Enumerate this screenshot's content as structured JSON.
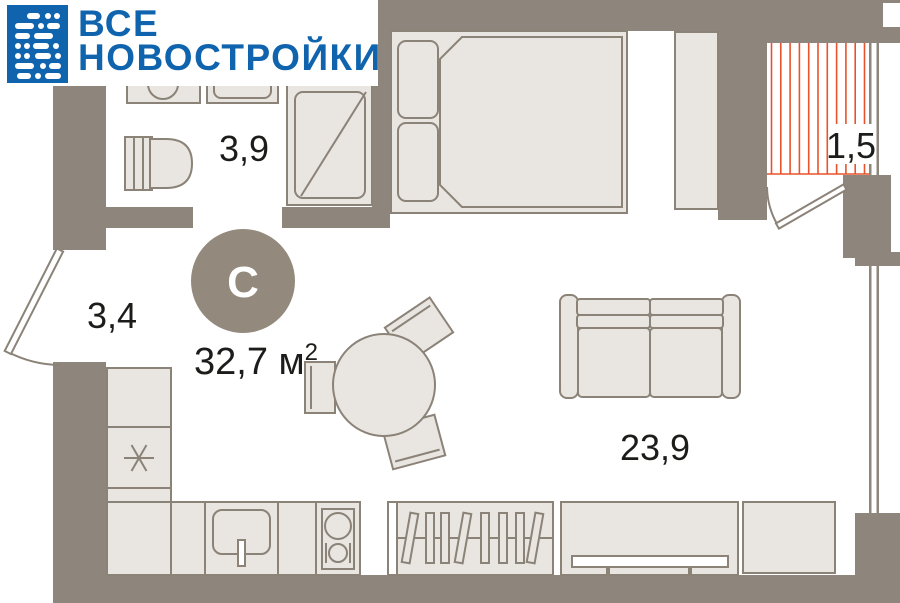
{
  "brand": {
    "line1": "ВСЕ",
    "line2": "НОВОСТРОЙКИ",
    "color": "#1064ad"
  },
  "plan": {
    "badge": "С",
    "total_area": "32,7 м",
    "total_area_superscript": "2",
    "rooms": [
      {
        "id": "bathroom",
        "area": "3,9"
      },
      {
        "id": "hallway",
        "area": "3,4"
      },
      {
        "id": "balcony",
        "area": "1,5"
      },
      {
        "id": "living-room",
        "area": "23,9"
      }
    ],
    "colors": {
      "wall": "#8e867d",
      "badge_fill": "#93897d",
      "furniture_fill": "#e9e6e1",
      "furniture_stroke": "#8b8278",
      "balcony_hatch": "#e8532c",
      "label": "#1c1c1a"
    }
  }
}
